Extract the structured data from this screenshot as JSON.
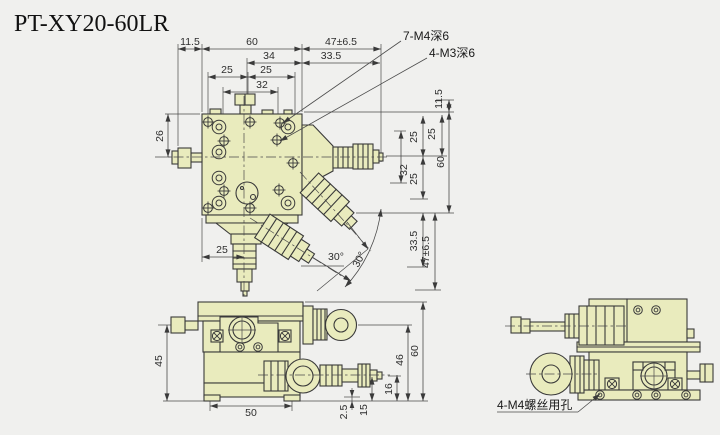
{
  "title": "PT-XY20-60LR",
  "colors": {
    "background": "#f0f0ee",
    "part_fill": "#e9ebbd",
    "outline": "#3a3a3a",
    "dimension": "#4a4a4a"
  },
  "annotations": {
    "m4_tapped": "7-M4深6",
    "m3_tapped": "4-M3深6",
    "m4_clearance": "4-M4螺丝用孔"
  },
  "top": {
    "h": {
      "offset": "11.5",
      "body": "60",
      "travel": "47±6.5",
      "r2a": "34",
      "r2b": "33.5",
      "r3a": "25",
      "r3b": "25",
      "r4": "32"
    },
    "v": {
      "offset": "11.5",
      "a": "25",
      "b": "25",
      "c": "32",
      "d": "25",
      "body": "60",
      "r2": "33.5",
      "travel": "47±6.5"
    },
    "left": "26",
    "bottom": "25",
    "angle1": "30°",
    "angle2": "30°"
  },
  "front": {
    "width": "50",
    "height": "45",
    "total_height": "60",
    "axis_height": "46",
    "d16": "16",
    "d15": "15",
    "d2_5": "2.5"
  }
}
